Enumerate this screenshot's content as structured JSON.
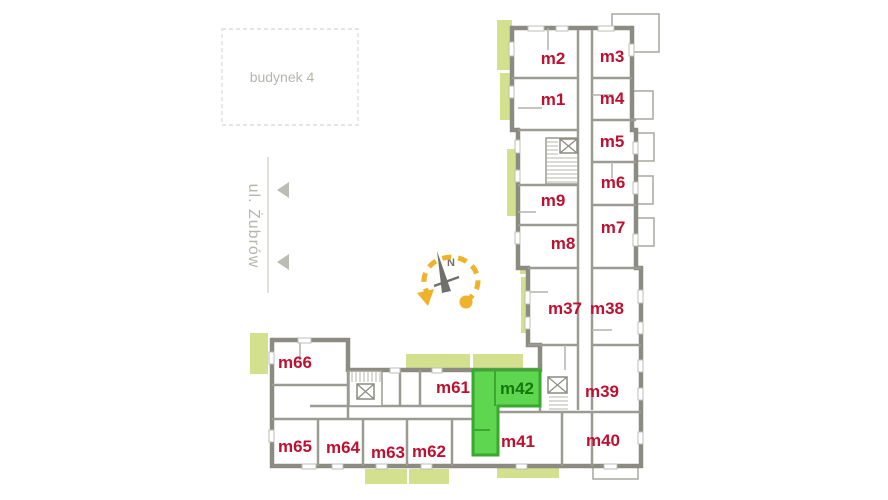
{
  "site": {
    "building_box": {
      "label": "budynek 4"
    },
    "street": {
      "label": "ul. Żubrów"
    },
    "compass": {
      "north_label": "N"
    }
  },
  "floorplan": {
    "highlighted_apartment": "m42",
    "apartments": [
      {
        "id": "m2",
        "x": 553,
        "y": 58,
        "highlighted": false
      },
      {
        "id": "m3",
        "x": 612,
        "y": 56,
        "highlighted": false
      },
      {
        "id": "m1",
        "x": 553,
        "y": 99,
        "highlighted": false
      },
      {
        "id": "m4",
        "x": 612,
        "y": 98,
        "highlighted": false
      },
      {
        "id": "m5",
        "x": 612,
        "y": 141,
        "highlighted": false
      },
      {
        "id": "m6",
        "x": 613,
        "y": 182,
        "highlighted": false
      },
      {
        "id": "m9",
        "x": 553,
        "y": 200,
        "highlighted": false
      },
      {
        "id": "m7",
        "x": 613,
        "y": 227,
        "highlighted": false
      },
      {
        "id": "m8",
        "x": 563,
        "y": 243,
        "highlighted": false
      },
      {
        "id": "m37",
        "x": 565,
        "y": 308,
        "highlighted": false
      },
      {
        "id": "m38",
        "x": 607,
        "y": 308,
        "highlighted": false
      },
      {
        "id": "m39",
        "x": 602,
        "y": 391,
        "highlighted": false
      },
      {
        "id": "m42",
        "x": 517,
        "y": 388,
        "highlighted": true
      },
      {
        "id": "m61",
        "x": 453,
        "y": 387,
        "highlighted": false
      },
      {
        "id": "m66",
        "x": 295,
        "y": 362,
        "highlighted": false
      },
      {
        "id": "m41",
        "x": 518,
        "y": 441,
        "highlighted": false
      },
      {
        "id": "m40",
        "x": 603,
        "y": 440,
        "highlighted": false
      },
      {
        "id": "m65",
        "x": 295,
        "y": 446,
        "highlighted": false
      },
      {
        "id": "m64",
        "x": 343,
        "y": 447,
        "highlighted": false
      },
      {
        "id": "m63",
        "x": 388,
        "y": 452,
        "highlighted": false
      },
      {
        "id": "m62",
        "x": 429,
        "y": 451,
        "highlighted": false
      }
    ]
  },
  "colors": {
    "apartment_label": "#be1030",
    "highlight_fill": "#5ed650",
    "highlight_wall": "#3aa72e",
    "highlight_label": "#17770d",
    "balcony_fill": "#d3e18f",
    "wall": "#8b8b81",
    "inner_wall": "#a2a299",
    "accent_yellow": "#eeb22b",
    "muted_text": "#b6b6af"
  }
}
